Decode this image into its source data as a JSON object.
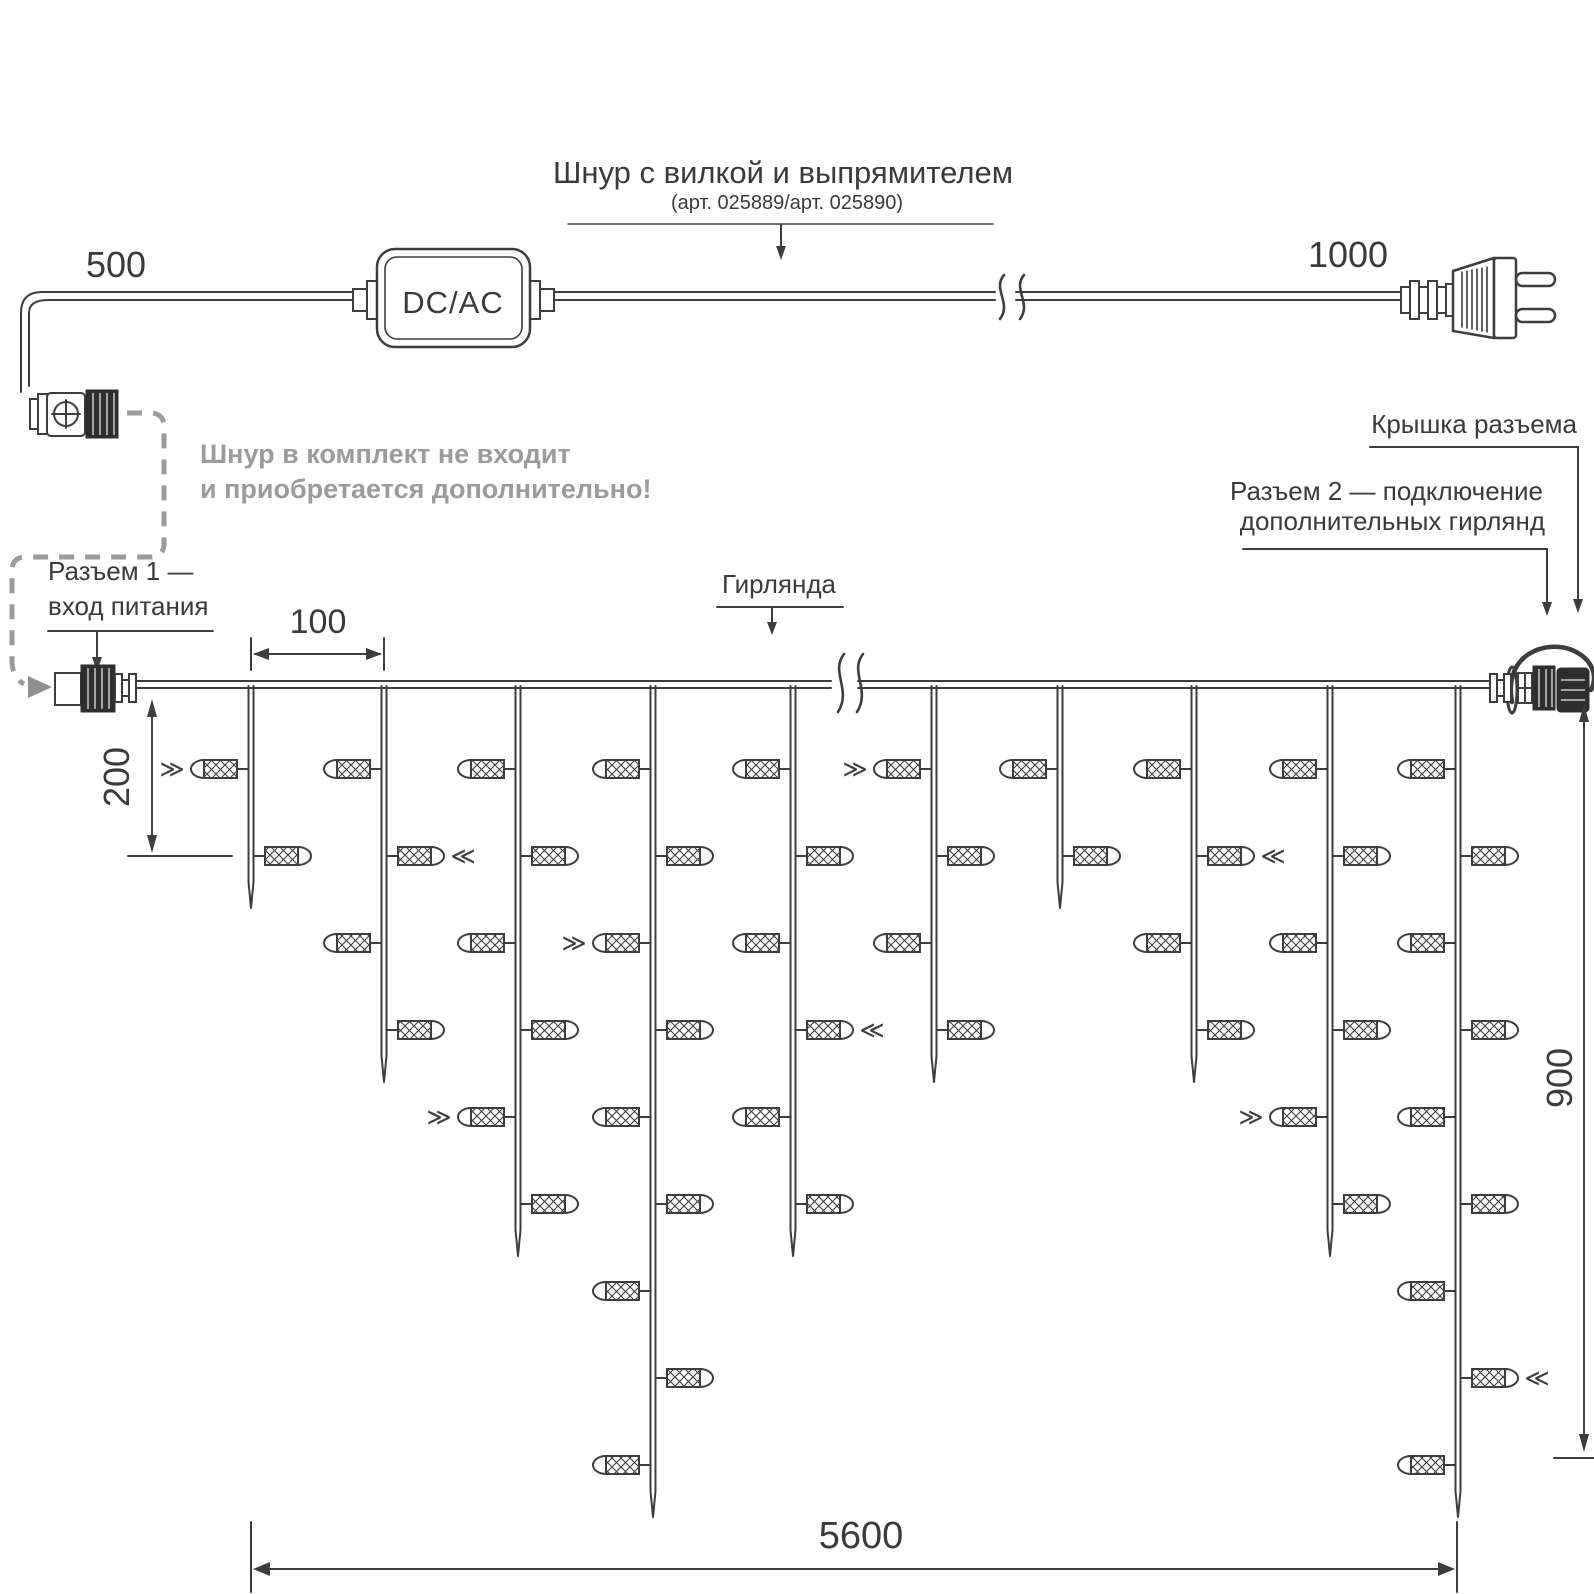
{
  "diagram": {
    "title": "Шнур с вилкой и выпрямителем",
    "subtitle": "(арт. 025889/арт. 025890)",
    "converter_label": "DC/AC",
    "note_line1": "Шнур в комплект не входит",
    "note_line2": "и приобретается дополнительно!",
    "connector1_line1": "Разъем 1 —",
    "connector1_line2": "вход питания",
    "garland_label": "Гирлянда",
    "cap_label": "Крышка разъема",
    "connector2_line1": "Разъем 2 — подключение",
    "connector2_line2": "дополнительных гирлянд"
  },
  "dimensions": {
    "cord_to_connector": "500",
    "cord_to_plug": "1000",
    "drop_spacing": "100",
    "first_bulb_offset": "200",
    "drop_max_height": "900",
    "total_length": "5600"
  },
  "colors": {
    "line": "#3d3d3d",
    "text": "#3a3a3a",
    "muted_gray": "#9b9b9b",
    "arrow_gray": "#8f8f8f",
    "background": "#ffffff"
  },
  "garland": {
    "wire_y": 686,
    "row_y": [
      769,
      856,
      943,
      1030,
      1117,
      1204,
      1291,
      1378,
      1465
    ],
    "rays_pointing_right": "≫",
    "rays_pointing_left": "≪",
    "drops": [
      {
        "x": 251,
        "bulbs": 2,
        "tip": 908,
        "rays_row": 1
      },
      {
        "x": 384,
        "bulbs": 4,
        "tip": 1082,
        "rays_row": 2
      },
      {
        "x": 518,
        "bulbs": 6,
        "tip": 1256,
        "rays_row": 5
      },
      {
        "x": 653,
        "bulbs": 9,
        "tip": 1517,
        "rays_row": 3
      },
      {
        "x": 793,
        "bulbs": 6,
        "tip": 1256,
        "rays_row": 4
      },
      {
        "x": 934,
        "bulbs": 4,
        "tip": 1082,
        "rays_row": 1
      },
      {
        "x": 1060,
        "bulbs": 2,
        "tip": 908,
        "rays_row": 0
      },
      {
        "x": 1194,
        "bulbs": 4,
        "tip": 1082,
        "rays_row": 2
      },
      {
        "x": 1330,
        "bulbs": 6,
        "tip": 1256,
        "rays_row": 5
      },
      {
        "x": 1458,
        "bulbs": 9,
        "tip": 1517,
        "rays_row": 8
      }
    ]
  }
}
